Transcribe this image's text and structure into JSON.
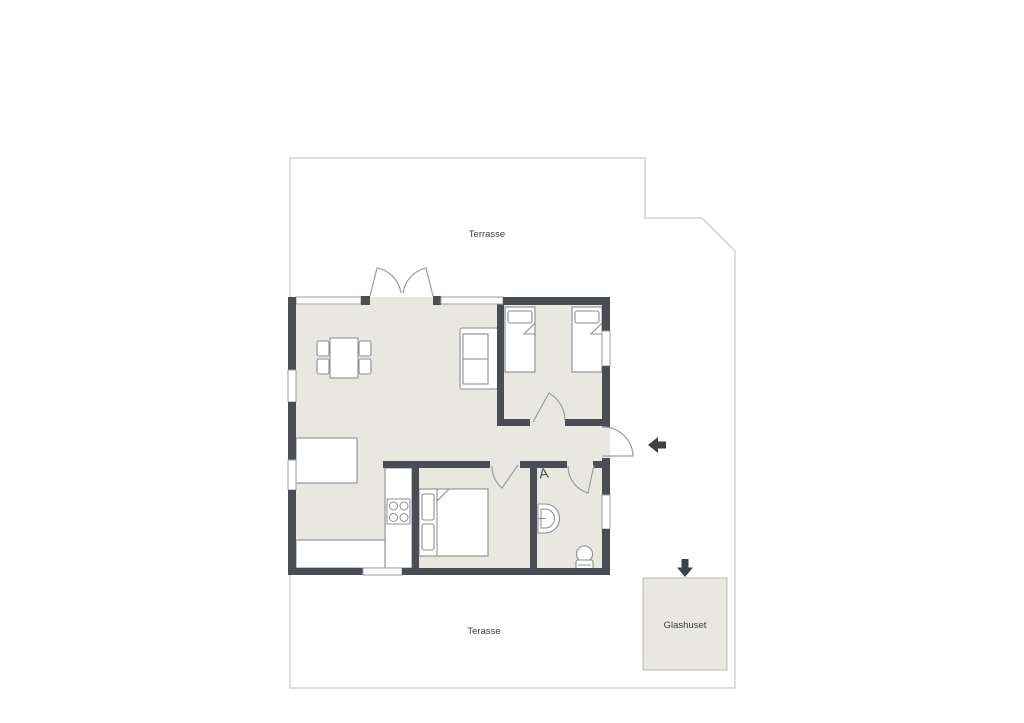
{
  "labels": {
    "terrace_top": "Terrasse",
    "terrace_bottom": "Terasse",
    "glashuset": "Glashuset",
    "attic_ladder_glyph": "A"
  },
  "icons": {
    "entry_arrow": "arrow-left",
    "glashuset_entry_arrow": "arrow-down",
    "attic_ladder": "letter-A-ladder-mark",
    "stove": "four-burner-cooktop",
    "toilet": "toilet",
    "sink": "wash-basin"
  },
  "colors": {
    "background": "#ffffff",
    "floor": "#e8e8e0",
    "wall": "#4a4e54",
    "terrace_line": "#d4d4d4",
    "furniture_stroke": "#8e8e8e",
    "arrow": "#3d4248",
    "glashuset_fill": "#e8e8e0",
    "glashuset_border": "#b8b8b0",
    "label": "#3d3d3d"
  }
}
